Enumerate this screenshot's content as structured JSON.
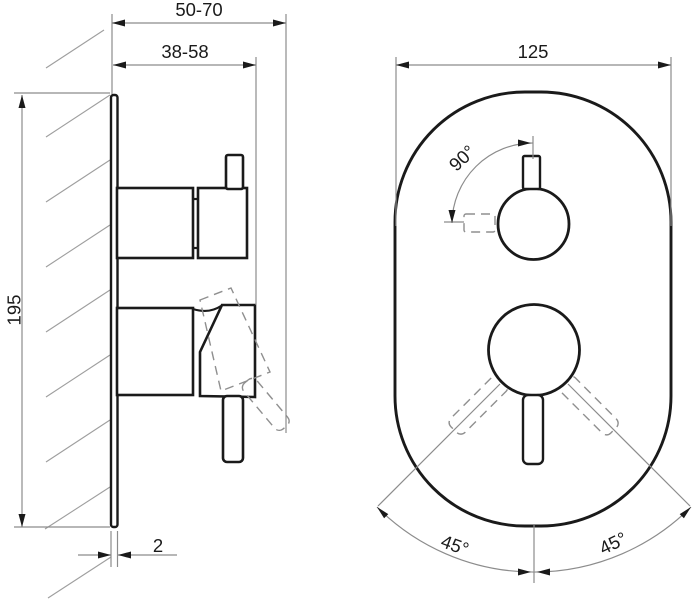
{
  "drawing": {
    "type": "technical-drawing",
    "subject": "concealed-shower-mixer-installation-dimensions",
    "views": {
      "side_view": {
        "dim_total_depth": "50-70",
        "dim_trim_depth": "38-58",
        "dim_height": "195",
        "dim_plate_thickness": "2"
      },
      "front_view": {
        "dim_width": "125",
        "dim_top_handle_angle": "90°",
        "dim_lever_angle_left": "45°",
        "dim_lever_angle_right": "45°"
      }
    },
    "colors": {
      "outline": "#1a1a1a",
      "dimension_line": "#8c8c8c",
      "hatch": "#9e9e9e",
      "ghost": "#8f8f8f",
      "background": "#ffffff"
    }
  }
}
